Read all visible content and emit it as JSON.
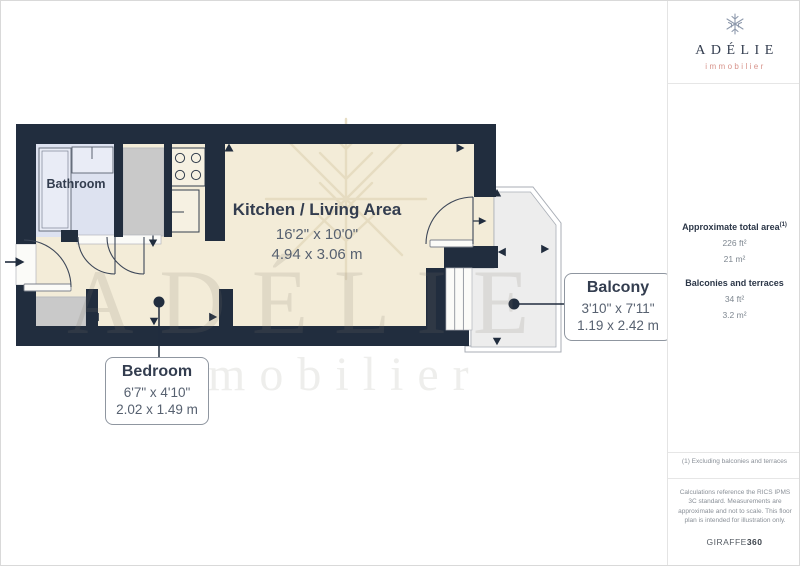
{
  "brand": {
    "name": "ADÉLIE",
    "tagline": "immobilier"
  },
  "watermark": {
    "line1": "ADÉLIE",
    "line2": "immobilier"
  },
  "floor_plan": {
    "rooms": [
      {
        "id": "bathroom",
        "label": "Bathroom"
      },
      {
        "id": "kitchen_living",
        "label": "Kitchen / Living Area",
        "dimensions_imperial": "16'2\" x 10'0\"",
        "dimensions_metric": "4.94 x 3.06 m"
      },
      {
        "id": "bedroom",
        "label": "Bedroom",
        "dimensions_imperial": "6'7\" x 4'10\"",
        "dimensions_metric": "2.02 x 1.49 m"
      },
      {
        "id": "balcony",
        "label": "Balcony",
        "dimensions_imperial": "3'10\" x 7'11\"",
        "dimensions_metric": "1.19 x 2.42 m"
      }
    ]
  },
  "sidebar": {
    "total_area": {
      "label": "Approximate total area",
      "note_ref": "(1)",
      "imperial": "226 ft²",
      "metric": "21 m²"
    },
    "balconies_terraces": {
      "label": "Balconies and terraces",
      "imperial": "34 ft²",
      "metric": "3.2 m²"
    },
    "footnote": "(1) Excluding balconies and terraces",
    "disclaimer": "Calculations reference the RICS IPMS 3C standard. Measurements are approximate and not to scale. This floor plan is intended for illustration only.",
    "provider_name": "GIRAFFE",
    "provider_suffix": "360"
  },
  "colors": {
    "wall": "#212d3e",
    "floor": "#f3ecd8",
    "bathfloor": "#dde2f0",
    "balconyfloor": "#ededed",
    "furniture": "#c9c9c9",
    "navy": "#333d4f",
    "coral": "#d7928a",
    "dimtext": "#576170",
    "motif": "#e4dabf"
  }
}
